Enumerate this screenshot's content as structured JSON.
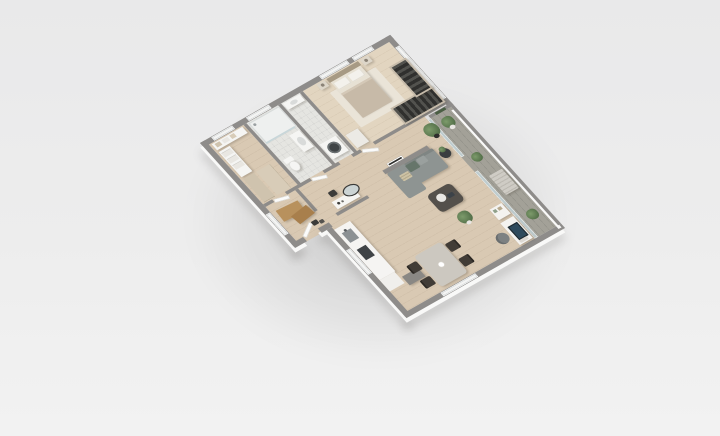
{
  "scene": {
    "type": "3d-isometric-floor-plan",
    "description": "Top-down 3D render of a one-bedroom apartment on a plain light background",
    "rooms": [
      {
        "name": "bedroom"
      },
      {
        "name": "bathroom"
      },
      {
        "name": "wc-laundry"
      },
      {
        "name": "walk-in-closet"
      },
      {
        "name": "office-nook"
      },
      {
        "name": "hallway"
      },
      {
        "name": "living-room"
      },
      {
        "name": "kitchen"
      },
      {
        "name": "dining-area"
      },
      {
        "name": "balcony"
      }
    ],
    "furniture": [
      "double-bed",
      "nightstand",
      "wardrobe",
      "dresser",
      "shower",
      "toilet",
      "bathroom-sink",
      "washing-machine",
      "linen-shelf",
      "closet-cabinet",
      "office-desk",
      "vanity-table",
      "vanity-mirror",
      "stool",
      "sofa",
      "coffee-table",
      "side-table",
      "wall-art",
      "dining-table",
      "dining-chair",
      "kitchen-counter",
      "kitchen-sink",
      "cooktop",
      "kitchen-island",
      "computer-desk",
      "monitor",
      "desk-chair",
      "bookshelf",
      "potted-plant",
      "balcony-bench"
    ]
  },
  "palette": {
    "bg_top": "#e9e9ea",
    "bg_mid": "#ededed",
    "bg_bottom": "#f2f2f2",
    "wall_top": "#8e8c8a",
    "wall_face": "#f9f9f8",
    "floor_wood": "#d9c9b3",
    "floor_wood_light": "#e2d5c0",
    "floor_tile": "#e5e5e1",
    "floor_balcony": "#a3a198",
    "window_glass": "#f4f4f3",
    "balcony_glass": "#c3d4d8",
    "door_leaf": "#fbfbfa",
    "rug": "#eae4d8",
    "headboard": "#a79a84",
    "mattress": "#e7e1d4",
    "pillow": "#f3f1ec",
    "blanket": "#c7baa8",
    "blanket_fold": "#d4c8b7",
    "nightstand": "#ddd6c9",
    "dresser": "#eceae5",
    "wardrobe_dark": "#30302e",
    "wardrobe_frame": "#c6bbaa",
    "shower_tray": "#eef0ef",
    "white_fixture": "#f5f5f3",
    "basin": "#d9dbda",
    "washer_door": "#3f4446",
    "closet_cabinet": "#cfc3ae",
    "closet_cabinet2": "#d8ccb8",
    "linen": "#e9e7e2",
    "office_desk": "#b8915d",
    "office_desk2": "#a87f4c",
    "vanity": "#f6f5f2",
    "mirror_face": "#ccd4d4",
    "stool_dark": "#3c3c3a",
    "sofa": "#8e9492",
    "sofa_shade": "#7f8583",
    "cushion_green": "#66756a",
    "cushion_gray": "#9aa09e",
    "cushion_stripe": "#cdc2a5",
    "side_table": "#3a3e40",
    "coffee_table": "#54504b",
    "tray": "#e9e7e3",
    "plant_green": "#55714a",
    "plant_light": "#7d9b6b",
    "pot_dark": "#2e2e2c",
    "pot_white": "#e8e6e2",
    "desk_white": "#f4f3f0",
    "monitor_screen": "#2e4a5c",
    "desk_chair": "#7d8182",
    "dining_table": "#ccc8c0",
    "dining_chair": "#413c36",
    "kitchen_counter": "#f5f4f2",
    "kitchen_sink": "#8b9093",
    "cooktop": "#3f4347",
    "kitchen_island": "#8a8884",
    "bench": "#cfccc5",
    "planter_green": "#4a5e43",
    "art_frame": "#2f2f2d"
  }
}
